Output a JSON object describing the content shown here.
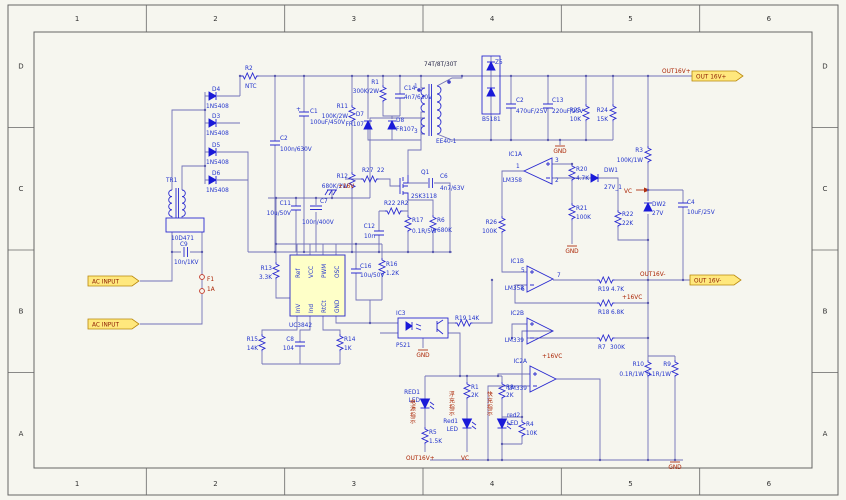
{
  "meta": {
    "bg": "#f6f6ef",
    "wire_color": "#7272b8",
    "symbol_color": "#2a2ad0",
    "component_text_color": "#2233cc",
    "net_text_color": "#aa2200",
    "port_fill": "#ffe87d",
    "port_edge": "#b8860b",
    "ic_fill": "#feffc8"
  },
  "frame": {
    "cols": [
      "1",
      "2",
      "3",
      "4",
      "5",
      "6"
    ],
    "rows": [
      "D",
      "C",
      "B",
      "A"
    ]
  },
  "gnd_label": "GND",
  "ports": [
    {
      "label": "AC INPUT",
      "x": 88,
      "y": 276
    },
    {
      "label": "AC INPUT",
      "x": 88,
      "y": 319
    },
    {
      "label": "OUT 16V+",
      "x": 692,
      "y": 71
    },
    {
      "label": "OUT 16V-",
      "x": 690,
      "y": 275
    }
  ],
  "grounds": [
    {
      "x": 572,
      "y": 246
    },
    {
      "x": 560,
      "y": 146
    },
    {
      "x": 423,
      "y": 350
    },
    {
      "x": 675,
      "y": 462
    }
  ],
  "labels": [
    {
      "t": "D4",
      "x": 212,
      "y": 91
    },
    {
      "t": "1N5408",
      "x": 206,
      "y": 108
    },
    {
      "t": "D3",
      "x": 212,
      "y": 118
    },
    {
      "t": "1N5408",
      "x": 206,
      "y": 135
    },
    {
      "t": "D5",
      "x": 212,
      "y": 147
    },
    {
      "t": "1N5408",
      "x": 206,
      "y": 164
    },
    {
      "t": "D6",
      "x": 212,
      "y": 175
    },
    {
      "t": "1N5408",
      "x": 206,
      "y": 192
    },
    {
      "t": "R2",
      "x": 245,
      "y": 70
    },
    {
      "t": "NTC",
      "x": 245,
      "y": 88
    },
    {
      "t": "TR1",
      "x": 166,
      "y": 182
    },
    {
      "t": "10D471",
      "x": 171,
      "y": 240
    },
    {
      "t": "C9",
      "x": 180,
      "y": 246
    },
    {
      "t": "10n/1KV",
      "x": 174,
      "y": 264
    },
    {
      "t": "F1",
      "cl": "r",
      "x": 207,
      "y": 281
    },
    {
      "t": "1A",
      "cl": "r",
      "x": 207,
      "y": 291
    },
    {
      "t": "C2",
      "x": 280,
      "y": 140
    },
    {
      "t": "100n/630V",
      "x": 280,
      "y": 151
    },
    {
      "t": "+",
      "x": 296,
      "y": 111,
      "s": 5
    },
    {
      "t": "C1",
      "x": 310,
      "y": 113
    },
    {
      "t": "100uF/450V",
      "x": 310,
      "y": 124
    },
    {
      "t": "R11",
      "x": 348,
      "y": 108,
      "a": "e"
    },
    {
      "t": "100K/2W",
      "x": 348,
      "y": 118,
      "a": "e"
    },
    {
      "t": "R12",
      "x": 348,
      "y": 178,
      "a": "e"
    },
    {
      "t": "680K/2W",
      "x": 348,
      "y": 188,
      "a": "e"
    },
    {
      "t": "R1",
      "x": 379,
      "y": 84,
      "a": "e"
    },
    {
      "t": "300K/2W",
      "x": 379,
      "y": 93,
      "a": "e"
    },
    {
      "t": "C14",
      "x": 404,
      "y": 90
    },
    {
      "t": "4n7/630V",
      "x": 404,
      "y": 99
    },
    {
      "t": "D7",
      "x": 364,
      "y": 116,
      "a": "e"
    },
    {
      "t": "FR107",
      "x": 364,
      "y": 126,
      "a": "e"
    },
    {
      "t": "D8",
      "x": 396,
      "y": 122
    },
    {
      "t": "FR107",
      "x": 396,
      "y": 131
    },
    {
      "t": "74T/8T/30T",
      "x": 424,
      "y": 66,
      "s": 6.5,
      "cl": "k"
    },
    {
      "t": "EE40-1",
      "x": 436,
      "y": 143
    },
    {
      "t": "1",
      "x": 414,
      "y": 88,
      "s": 5
    },
    {
      "t": "3",
      "x": 414,
      "y": 133,
      "s": 5
    },
    {
      "t": "Z5",
      "x": 495,
      "y": 64
    },
    {
      "t": "B5181",
      "x": 482,
      "y": 121
    },
    {
      "t": "C2",
      "x": 516,
      "y": 102
    },
    {
      "t": "470uF/25V",
      "x": 516,
      "y": 113
    },
    {
      "t": "C13",
      "x": 552,
      "y": 102
    },
    {
      "t": "220uF/25V",
      "x": 552,
      "y": 113
    },
    {
      "t": "R25",
      "x": 581,
      "y": 112,
      "a": "e"
    },
    {
      "t": "10K",
      "x": 581,
      "y": 121,
      "a": "e"
    },
    {
      "t": "R24",
      "x": 608,
      "y": 112,
      "a": "e"
    },
    {
      "t": "15K",
      "x": 608,
      "y": 121,
      "a": "e"
    },
    {
      "t": "R3",
      "x": 643,
      "y": 152,
      "a": "e"
    },
    {
      "t": "100K/1W",
      "x": 643,
      "y": 162,
      "a": "e"
    },
    {
      "t": "OUT16V+",
      "cl": "r",
      "x": 662,
      "y": 73
    },
    {
      "t": "VC",
      "cl": "r",
      "x": 624,
      "y": 193
    },
    {
      "t": "DW2",
      "x": 652,
      "y": 206
    },
    {
      "t": "27V",
      "x": 652,
      "y": 215
    },
    {
      "t": "C4",
      "x": 687,
      "y": 204
    },
    {
      "t": "10uF/25V",
      "x": 687,
      "y": 214
    },
    {
      "t": "IC1A",
      "x": 522,
      "y": 156,
      "a": "e"
    },
    {
      "t": "LM358",
      "x": 522,
      "y": 182,
      "a": "e"
    },
    {
      "t": "3",
      "x": 555,
      "y": 162,
      "s": 5
    },
    {
      "t": "2",
      "x": 555,
      "y": 182,
      "s": 5
    },
    {
      "t": "1",
      "x": 516,
      "y": 168,
      "s": 5
    },
    {
      "t": "R20",
      "x": 576,
      "y": 171
    },
    {
      "t": "4.7K",
      "x": 576,
      "y": 180
    },
    {
      "t": "DW1",
      "x": 604,
      "y": 172
    },
    {
      "t": "27V_1",
      "x": 604,
      "y": 189
    },
    {
      "t": "R21",
      "x": 576,
      "y": 210
    },
    {
      "t": "100K",
      "x": 576,
      "y": 219
    },
    {
      "t": "R22",
      "x": 622,
      "y": 216
    },
    {
      "t": "22K",
      "x": 622,
      "y": 225
    },
    {
      "t": "R26",
      "x": 497,
      "y": 224,
      "a": "e"
    },
    {
      "t": "100K",
      "x": 497,
      "y": 233,
      "a": "e"
    },
    {
      "t": "IC1B",
      "x": 524,
      "y": 263,
      "a": "e"
    },
    {
      "t": "LM358",
      "x": 524,
      "y": 290,
      "a": "e"
    },
    {
      "t": "5",
      "x": 521,
      "y": 272,
      "s": 5
    },
    {
      "t": "6",
      "x": 521,
      "y": 291,
      "s": 5
    },
    {
      "t": "7",
      "x": 557,
      "y": 277,
      "s": 5
    },
    {
      "t": "R19",
      "x": 598,
      "y": 291
    },
    {
      "t": "4.7K",
      "x": 611,
      "y": 291
    },
    {
      "t": "OUT16V-",
      "cl": "r",
      "x": 640,
      "y": 276
    },
    {
      "t": "R18",
      "x": 598,
      "y": 314
    },
    {
      "t": "6.8K",
      "x": 611,
      "y": 314
    },
    {
      "t": "+16VC",
      "cl": "r",
      "x": 622,
      "y": 299
    },
    {
      "t": "R7",
      "x": 598,
      "y": 349
    },
    {
      "t": "300K",
      "x": 610,
      "y": 349
    },
    {
      "t": "IC2B",
      "x": 524,
      "y": 315,
      "a": "e"
    },
    {
      "t": "LM339",
      "x": 524,
      "y": 342,
      "a": "e"
    },
    {
      "t": "IC2A",
      "x": 527,
      "y": 363,
      "a": "e"
    },
    {
      "t": "LM339",
      "x": 527,
      "y": 390,
      "a": "e"
    },
    {
      "t": "+16VC",
      "cl": "r",
      "x": 542,
      "y": 358
    },
    {
      "t": "R10",
      "x": 644,
      "y": 366,
      "a": "e"
    },
    {
      "t": "0.1R/1W",
      "x": 644,
      "y": 376,
      "a": "e"
    },
    {
      "t": "R9",
      "x": 671,
      "y": 366,
      "a": "e"
    },
    {
      "t": "0.1R/1W",
      "x": 671,
      "y": 376,
      "a": "e"
    },
    {
      "t": "IC3",
      "x": 396,
      "y": 315
    },
    {
      "t": "P521",
      "x": 396,
      "y": 347
    },
    {
      "t": "R19",
      "x": 455,
      "y": 320
    },
    {
      "t": "14K",
      "x": 468,
      "y": 320
    },
    {
      "t": "UC3842",
      "x": 289,
      "y": 327
    },
    {
      "t": "Ref",
      "x": 300,
      "y": 278,
      "rot": -90,
      "s": 5
    },
    {
      "t": "VCC",
      "x": 313,
      "y": 278,
      "rot": -90,
      "s": 5
    },
    {
      "t": "PWM",
      "x": 326,
      "y": 278,
      "rot": -90,
      "s": 5
    },
    {
      "t": "OSC",
      "x": 339,
      "y": 278,
      "rot": -90,
      "s": 5
    },
    {
      "t": "InV",
      "x": 300,
      "y": 313,
      "rot": -90,
      "s": 5
    },
    {
      "t": "Ind",
      "x": 313,
      "y": 313,
      "rot": -90,
      "s": 5
    },
    {
      "t": "RtCt",
      "x": 326,
      "y": 313,
      "rot": -90,
      "s": 5
    },
    {
      "t": "GND",
      "x": 339,
      "y": 313,
      "rot": -90,
      "s": 5
    },
    {
      "t": "R13",
      "x": 272,
      "y": 270,
      "a": "e"
    },
    {
      "t": "3.3K",
      "x": 272,
      "y": 279,
      "a": "e"
    },
    {
      "t": "C16",
      "x": 360,
      "y": 268
    },
    {
      "t": "10u/50V",
      "x": 360,
      "y": 277
    },
    {
      "t": "R16",
      "x": 386,
      "y": 266
    },
    {
      "t": "1.2K",
      "x": 386,
      "y": 275
    },
    {
      "t": "R15",
      "x": 258,
      "y": 341,
      "a": "e"
    },
    {
      "t": "14K",
      "x": 258,
      "y": 350,
      "a": "e"
    },
    {
      "t": "C8",
      "x": 294,
      "y": 341,
      "a": "e"
    },
    {
      "t": "104",
      "x": 294,
      "y": 350,
      "a": "e"
    },
    {
      "t": "R14",
      "x": 344,
      "y": 341
    },
    {
      "t": "1K",
      "x": 344,
      "y": 350
    },
    {
      "t": "Q1",
      "x": 421,
      "y": 174
    },
    {
      "t": "2SK3118",
      "x": 411,
      "y": 198
    },
    {
      "t": "R27",
      "x": 362,
      "y": 172
    },
    {
      "t": "22",
      "x": 377,
      "y": 172
    },
    {
      "t": "R22",
      "x": 384,
      "y": 205
    },
    {
      "t": "2R2",
      "x": 397,
      "y": 205
    },
    {
      "t": "R17",
      "x": 412,
      "y": 222
    },
    {
      "t": "0.1R/5W",
      "x": 412,
      "y": 233
    },
    {
      "t": "R6",
      "x": 437,
      "y": 222
    },
    {
      "t": "680K",
      "x": 437,
      "y": 232
    },
    {
      "t": "C6",
      "x": 440,
      "y": 178
    },
    {
      "t": "4n7/63V",
      "x": 440,
      "y": 190
    },
    {
      "t": "C12",
      "x": 375,
      "y": 228,
      "a": "e"
    },
    {
      "t": "10n",
      "x": 375,
      "y": 238,
      "a": "e"
    },
    {
      "t": "C11",
      "x": 291,
      "y": 205,
      "a": "e"
    },
    {
      "t": "10u/50V",
      "x": 291,
      "y": 215,
      "a": "e"
    },
    {
      "t": "C7",
      "x": 320,
      "y": 203
    },
    {
      "t": "100n/400V",
      "x": 302,
      "y": 224
    },
    {
      "t": "+16V",
      "cl": "r",
      "x": 338,
      "y": 188
    },
    {
      "t": "RED1",
      "x": 420,
      "y": 394,
      "a": "e"
    },
    {
      "t": "LED",
      "x": 420,
      "y": 402,
      "a": "e"
    },
    {
      "t": "电源指示",
      "cl": "r",
      "x": 410,
      "y": 404,
      "v": 1
    },
    {
      "t": "R5",
      "x": 429,
      "y": 434
    },
    {
      "t": "1.5K",
      "x": 429,
      "y": 443
    },
    {
      "t": "OUT16V+",
      "cl": "r",
      "x": 406,
      "y": 460
    },
    {
      "t": "R1",
      "x": 471,
      "y": 389
    },
    {
      "t": "2K",
      "x": 471,
      "y": 397
    },
    {
      "t": "Red1",
      "x": 458,
      "y": 423,
      "a": "e"
    },
    {
      "t": "LED",
      "x": 458,
      "y": 431,
      "a": "e"
    },
    {
      "t": "浮充指示",
      "cl": "r",
      "x": 449,
      "y": 396,
      "v": 1
    },
    {
      "t": "VC",
      "cl": "r",
      "x": 461,
      "y": 460
    },
    {
      "t": "R8",
      "x": 506,
      "y": 389
    },
    {
      "t": "2K",
      "x": 506,
      "y": 397
    },
    {
      "t": "快充指示",
      "cl": "r",
      "x": 487,
      "y": 396,
      "v": 1
    },
    {
      "t": "red2",
      "x": 507,
      "y": 417
    },
    {
      "t": "LED",
      "x": 507,
      "y": 425
    },
    {
      "t": "R4",
      "x": 526,
      "y": 426
    },
    {
      "t": "10K",
      "x": 526,
      "y": 435
    }
  ]
}
